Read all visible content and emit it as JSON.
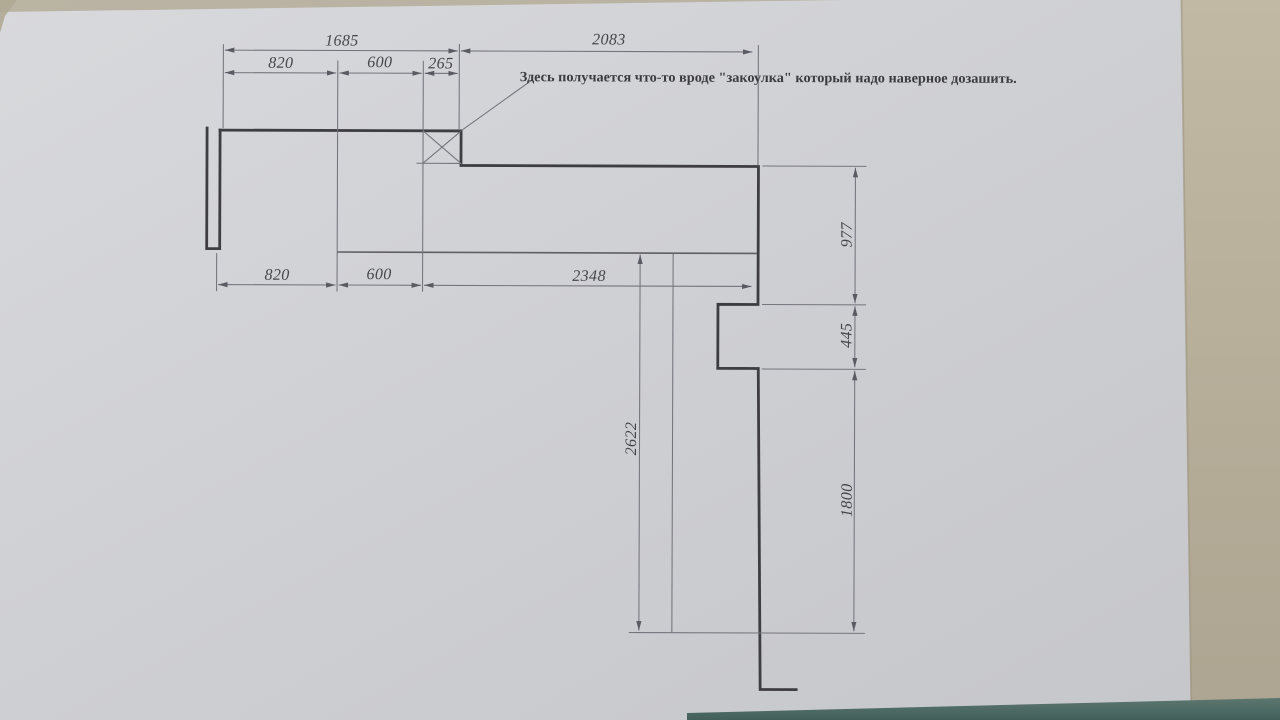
{
  "document": {
    "type": "photographed dimensioned sketch on paper",
    "note": "Здесь получается что-то вроде \"закоулка\" который надо наверное дозашить."
  },
  "dimensions": {
    "top_overall_left": "1685",
    "top_overall_right": "2083",
    "top_820": "820",
    "top_600": "600",
    "top_265": "265",
    "bottom_820": "820",
    "bottom_600": "600",
    "bottom_2348": "2348",
    "right_977": "977",
    "right_445": "445",
    "right_1800": "1800",
    "center_2622": "2622"
  },
  "colors": {
    "paper": "#cfd0d4",
    "desk": "#b7afa0",
    "table_strip": "#4d6a64",
    "wall_line": "#3e3e42",
    "dim_line": "#74747c",
    "label_text": "#45454a"
  }
}
